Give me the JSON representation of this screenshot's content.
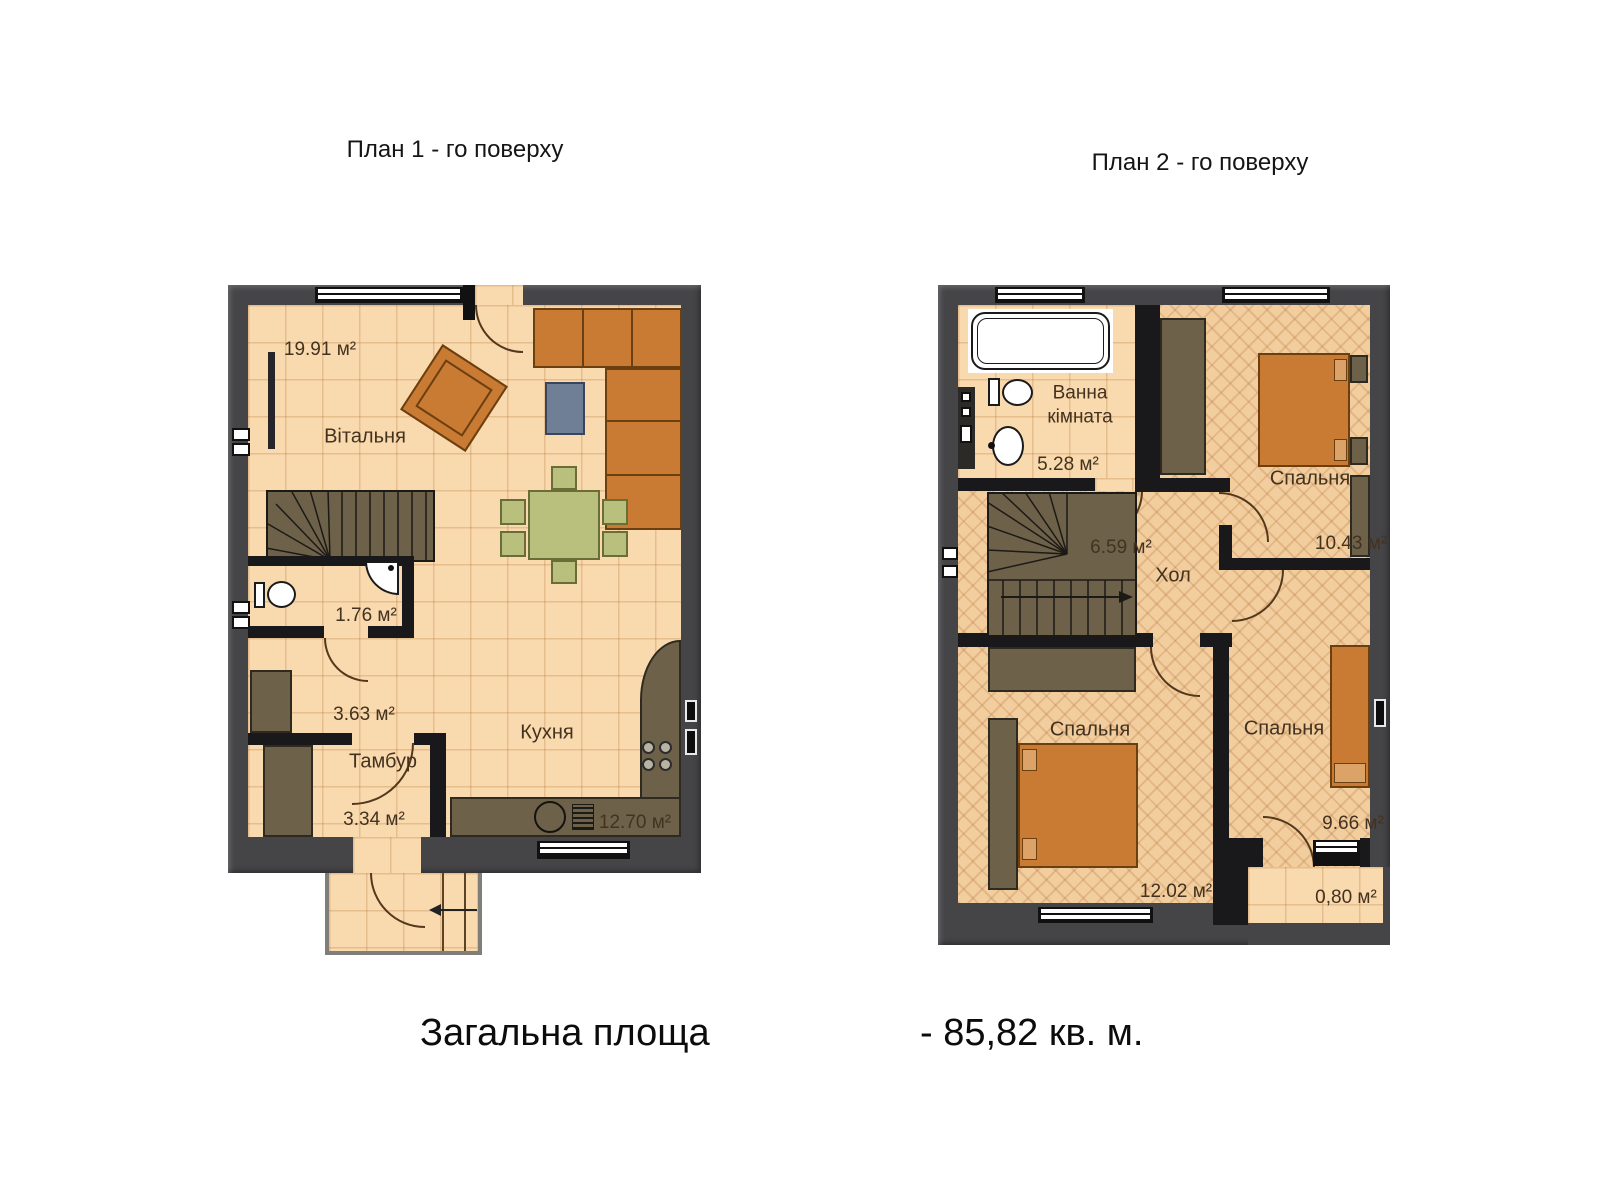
{
  "titles": {
    "plan1": "План 1 - го поверху",
    "plan2": "План 2 - го поверху"
  },
  "summary": {
    "label": "Загальна площа",
    "value": "- 85,82 кв. м."
  },
  "plan1": {
    "rooms": {
      "living": {
        "name": "Вітальня",
        "area": "19.91 м²"
      },
      "wc": {
        "area": "1.76 м²"
      },
      "hallway": {
        "area": "3.63 м²"
      },
      "vestibule": {
        "name": "Тамбур",
        "area": "3.34 м²"
      },
      "kitchen": {
        "name": "Кухня",
        "area": "12.70 м²"
      }
    }
  },
  "plan2": {
    "rooms": {
      "bathroom": {
        "name": "Ванна кімната",
        "area": "5.28 м²"
      },
      "hall": {
        "name": "Хол",
        "area": "6.59 м²"
      },
      "bedroom_top": {
        "name": "Спальня",
        "area": "10.43 м²"
      },
      "bedroom_left": {
        "name": "Спальня",
        "area": "12.02 м²"
      },
      "bedroom_right": {
        "name": "Спальня",
        "area": "9.66 м²"
      },
      "balcony": {
        "area": "0,80 м²"
      }
    }
  },
  "palette": {
    "floor_tile": "#f9d9ae",
    "floor_parquet": "#f2cd9e",
    "wall_outer": "#454447",
    "wall_inner": "#19181a",
    "furniture_orange": "#c97a33",
    "furniture_olive": "#6e614a",
    "dining_green": "#b9bf7d",
    "table_blue": "#6f8096"
  }
}
